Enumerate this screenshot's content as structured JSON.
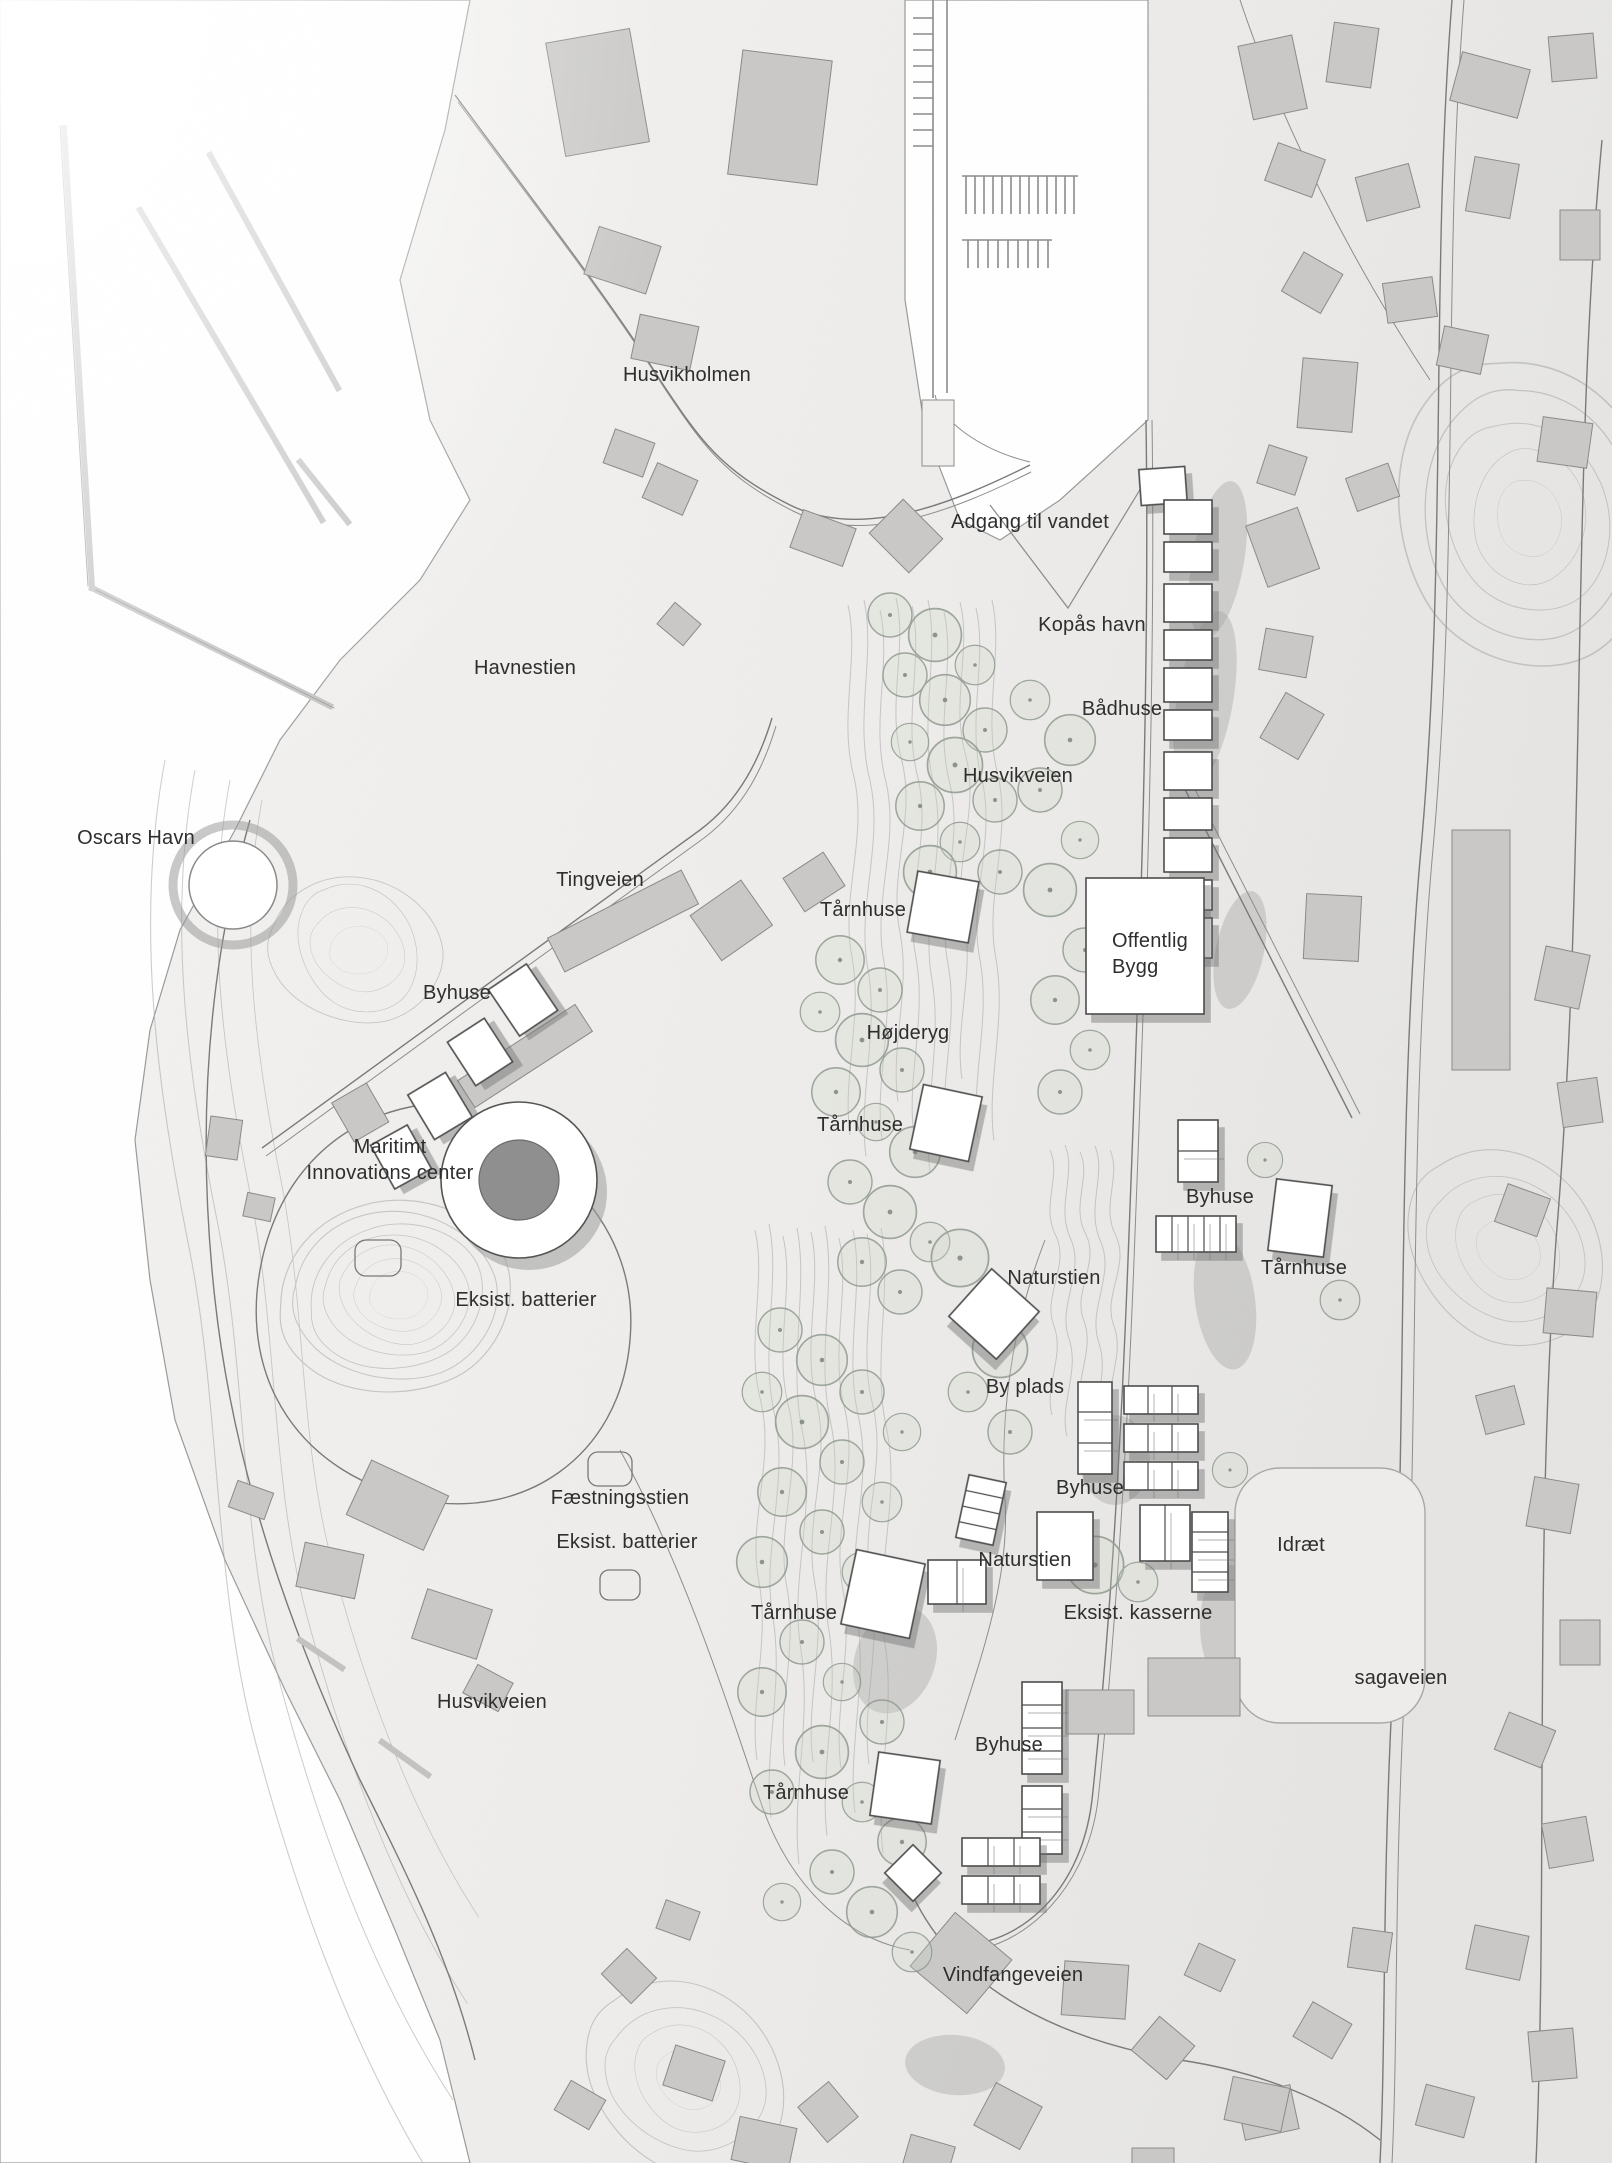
{
  "title": "Husvik masterplan site map",
  "colors": {
    "paper_light": "#ffffff",
    "paper_dark": "#e7e6e5",
    "water": "#ffffff",
    "contour": "#ababab",
    "existing_building": "#c9c8c7",
    "proposed_building": "#ffffff",
    "building_outline": "#4d4d4d",
    "shadow": "#a6a6a6",
    "tree_stroke": "#8f998f",
    "label_text": "#2e2e2e"
  },
  "labels": {
    "husvikholmen": "Husvikholmen",
    "adgang_til_vandet": "Adgang til vandet",
    "kopas_havn": "Kopås havn",
    "badhuse": "Bådhuse",
    "husvikveien_nord": "Husvikveien",
    "havnestien": "Havnestien",
    "oscars_havn": "Oscars Havn",
    "tingveien": "Tingveien",
    "tarnhuse_1": "Tårnhuse",
    "offentlig_bygg": "Offentlig\nBygg",
    "byhuse_1": "Byhuse",
    "hojderyg": "Højderyg",
    "maritimt_center": "Maritimt\nInnovations center",
    "tarnhuse_2": "Tårnhuse",
    "byhuse_2": "Byhuse",
    "tarnhuse_3": "Tårnhuse",
    "naturstien_1": "Naturstien",
    "eksist_batterier_1": "Eksist. batterier",
    "by_plads": "By plads",
    "byhuse_3": "Byhuse",
    "faestningsstien": "Fæstningsstien",
    "eksist_batterier_2": "Eksist. batterier",
    "naturstien_2": "Naturstien",
    "idraet": "Idræt",
    "tarnhuse_4": "Tårnhuse",
    "eksist_kasserne": "Eksist. kasserne",
    "sagaveien": "sagaveien",
    "husvikveien_syd": "Husvikveien",
    "byhuse_4": "Byhuse",
    "tarnhuse_5": "Tårnhuse",
    "vindfangeveien": "Vindfangeveien"
  }
}
